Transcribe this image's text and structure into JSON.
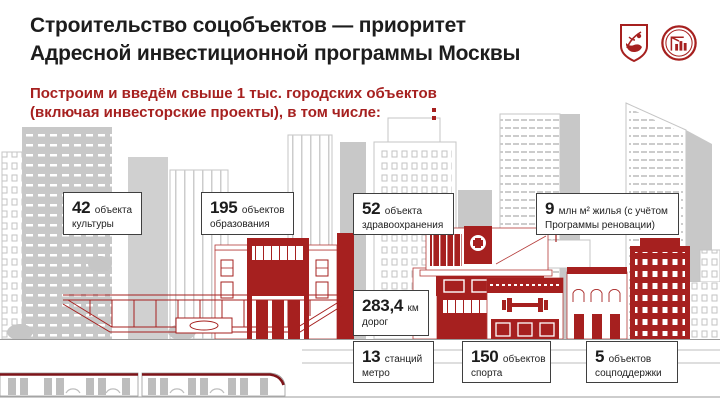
{
  "colors": {
    "accent_red": "#a6201f",
    "dark_red_roof": "#7d1419",
    "text_dark": "#1d1d1d",
    "building_gray": "#c8c8c8"
  },
  "header": {
    "title_line1": "Строительство соцобъектов — приоритет",
    "title_line2": "Адресной инвестиционной программы Москвы",
    "logo1": "moscow-coat-of-arms",
    "logo2": "moscow-construction-complex-emblem"
  },
  "subtitle": {
    "line1": "Построим и введём свыше 1 тыс. городских объектов",
    "line2": "(включая инвесторские проекты), в том числе:"
  },
  "stats": [
    {
      "id": "culture",
      "value": "42",
      "line1": "объекта",
      "line2": "культуры"
    },
    {
      "id": "education",
      "value": "195",
      "line1": "объектов",
      "line2": "образования"
    },
    {
      "id": "healthcare",
      "value": "52",
      "line1": "объекта",
      "line2": "здравоохранения"
    },
    {
      "id": "housing",
      "value": "9",
      "line1": "млн м² жилья (с учётом",
      "line2": "Программы реновации)"
    },
    {
      "id": "roads",
      "value": "283,4",
      "line1": "км",
      "line2": "дорог"
    },
    {
      "id": "metro",
      "value": "13",
      "line1": "станций",
      "line2": "метро"
    },
    {
      "id": "sport",
      "value": "150",
      "line1": "объектов",
      "line2": "спорта"
    },
    {
      "id": "social",
      "value": "5",
      "line1": "объектов",
      "line2": "соцподдержки"
    }
  ]
}
